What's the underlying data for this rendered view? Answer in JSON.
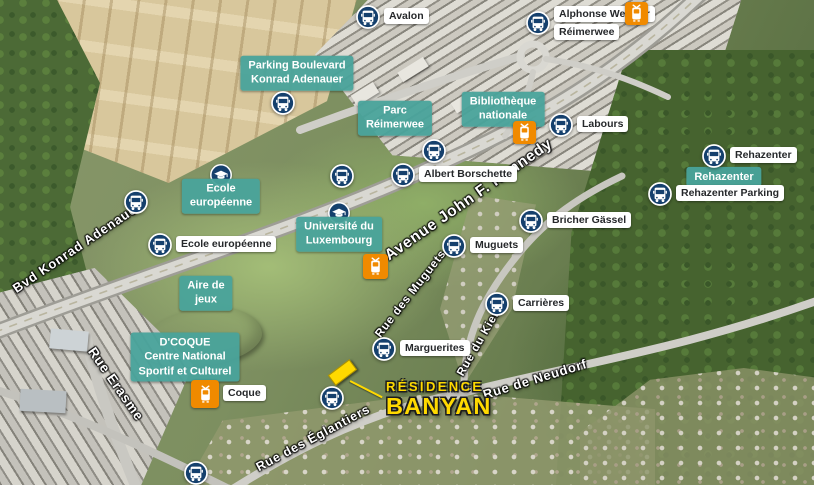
{
  "map": {
    "colors": {
      "teal": "rgba(73,163,155,0.95)",
      "navy": "#15406d",
      "orange": "#f08a00",
      "yellow": "#ffd900"
    },
    "residence": {
      "line1": "RÉSIDENCE",
      "line2": "BANYAN"
    },
    "stops": [
      {
        "label": "Avalon",
        "type": "bus",
        "side": "right",
        "x": 368,
        "y": 17
      },
      {
        "label": "Alphonse Weicker",
        "label2": "Réimerwee",
        "type": "bus",
        "side": "right",
        "x": 538,
        "y": 23,
        "tram_x": 636,
        "tram_y": 13,
        "tram_size": 23
      },
      {
        "label": "Konrad Adenauer",
        "type": "bus",
        "side": "left",
        "x": 283,
        "y": 103
      },
      {
        "label": "Nationalbibliothéik",
        "type": "tram",
        "side": "left",
        "x": 524,
        "y": 132,
        "size": 23
      },
      {
        "label": "Labours",
        "type": "bus",
        "side": "right",
        "x": 561,
        "y": 125
      },
      {
        "label": "Albert Borschette",
        "type": "bus",
        "side": "left",
        "x": 434,
        "y": 151
      },
      {
        "label": "Albert Borschette",
        "type": "bus",
        "side": "right",
        "x": 403,
        "y": 175
      },
      {
        "label": "Coudenhove-Kalergi",
        "type": "bus",
        "side": "left",
        "x": 342,
        "y": 176
      },
      {
        "label": "Antoine de St Exupéry",
        "type": "bus",
        "side": "left",
        "x": 136,
        "y": 202
      },
      {
        "label": "Ecole européenne",
        "type": "bus",
        "side": "right",
        "x": 160,
        "y": 245
      },
      {
        "label": "Rehazenter",
        "type": "bus",
        "side": "right",
        "x": 714,
        "y": 156
      },
      {
        "label": "Rehazenter Parking",
        "type": "bus",
        "side": "right",
        "x": 660,
        "y": 194
      },
      {
        "label": "Bricher Gässel",
        "type": "bus",
        "side": "right",
        "x": 531,
        "y": 221
      },
      {
        "label": "Muguets",
        "type": "bus",
        "side": "right",
        "x": 454,
        "y": 246
      },
      {
        "label": "Universitéit",
        "type": "tram",
        "side": "left",
        "x": 375,
        "y": 266,
        "size": 25
      },
      {
        "label": "Carrières",
        "type": "bus",
        "side": "right",
        "x": 497,
        "y": 304
      },
      {
        "label": "Marguerites",
        "type": "bus",
        "side": "right",
        "x": 384,
        "y": 349
      },
      {
        "label": "Pâquerettes",
        "type": "bus",
        "side": "left",
        "x": 332,
        "y": 398
      },
      {
        "label": "Coque",
        "type": "tram",
        "side": "right",
        "x": 205,
        "y": 394,
        "size": 28
      },
      {
        "label": "Bleuets",
        "type": "bus",
        "side": "left",
        "x": 196,
        "y": 473
      }
    ],
    "pois": [
      {
        "lines": [
          "Parking Boulevard",
          "Konrad Adenauer"
        ],
        "x": 297,
        "y": 73
      },
      {
        "lines": [
          "Parc",
          "Réimerwee"
        ],
        "x": 395,
        "y": 118
      },
      {
        "lines": [
          "Bibliothèque",
          "nationale"
        ],
        "x": 503,
        "y": 109
      },
      {
        "lines": [
          "Ecole",
          "européenne"
        ],
        "x": 221,
        "y": 196,
        "cap_y": 175
      },
      {
        "lines": [
          "Université du",
          "Luxembourg"
        ],
        "x": 339,
        "y": 234,
        "cap_y": 213
      },
      {
        "lines": [
          "Aire de",
          "jeux"
        ],
        "x": 206,
        "y": 293
      },
      {
        "lines": [
          "D'COQUE",
          "Centre National",
          "Sportif et Culturel"
        ],
        "x": 185,
        "y": 357
      },
      {
        "lines": [
          "Rehazenter"
        ],
        "x": 724,
        "y": 177
      }
    ],
    "streets": [
      {
        "name": "Avenue John F. Kennedy",
        "x": 469,
        "y": 200,
        "angle": -35,
        "size": 15.5
      },
      {
        "name": "Bvd Konrad Adenauer",
        "x": 77,
        "y": 247,
        "angle": -34,
        "size": 13
      },
      {
        "name": "Rue Erasme",
        "x": 116,
        "y": 384,
        "angle": 55,
        "size": 13.5
      },
      {
        "name": "Rue des Muguets",
        "x": 411,
        "y": 294,
        "angle": -52,
        "size": 11.5
      },
      {
        "name": "Rue du Kiem",
        "x": 480,
        "y": 341,
        "angle": -60,
        "size": 11.5
      },
      {
        "name": "Rue de Neudorf",
        "x": 535,
        "y": 379,
        "angle": -17,
        "size": 13
      },
      {
        "name": "Rue des Églantiers",
        "x": 313,
        "y": 438,
        "angle": -28,
        "size": 12.5
      }
    ]
  }
}
